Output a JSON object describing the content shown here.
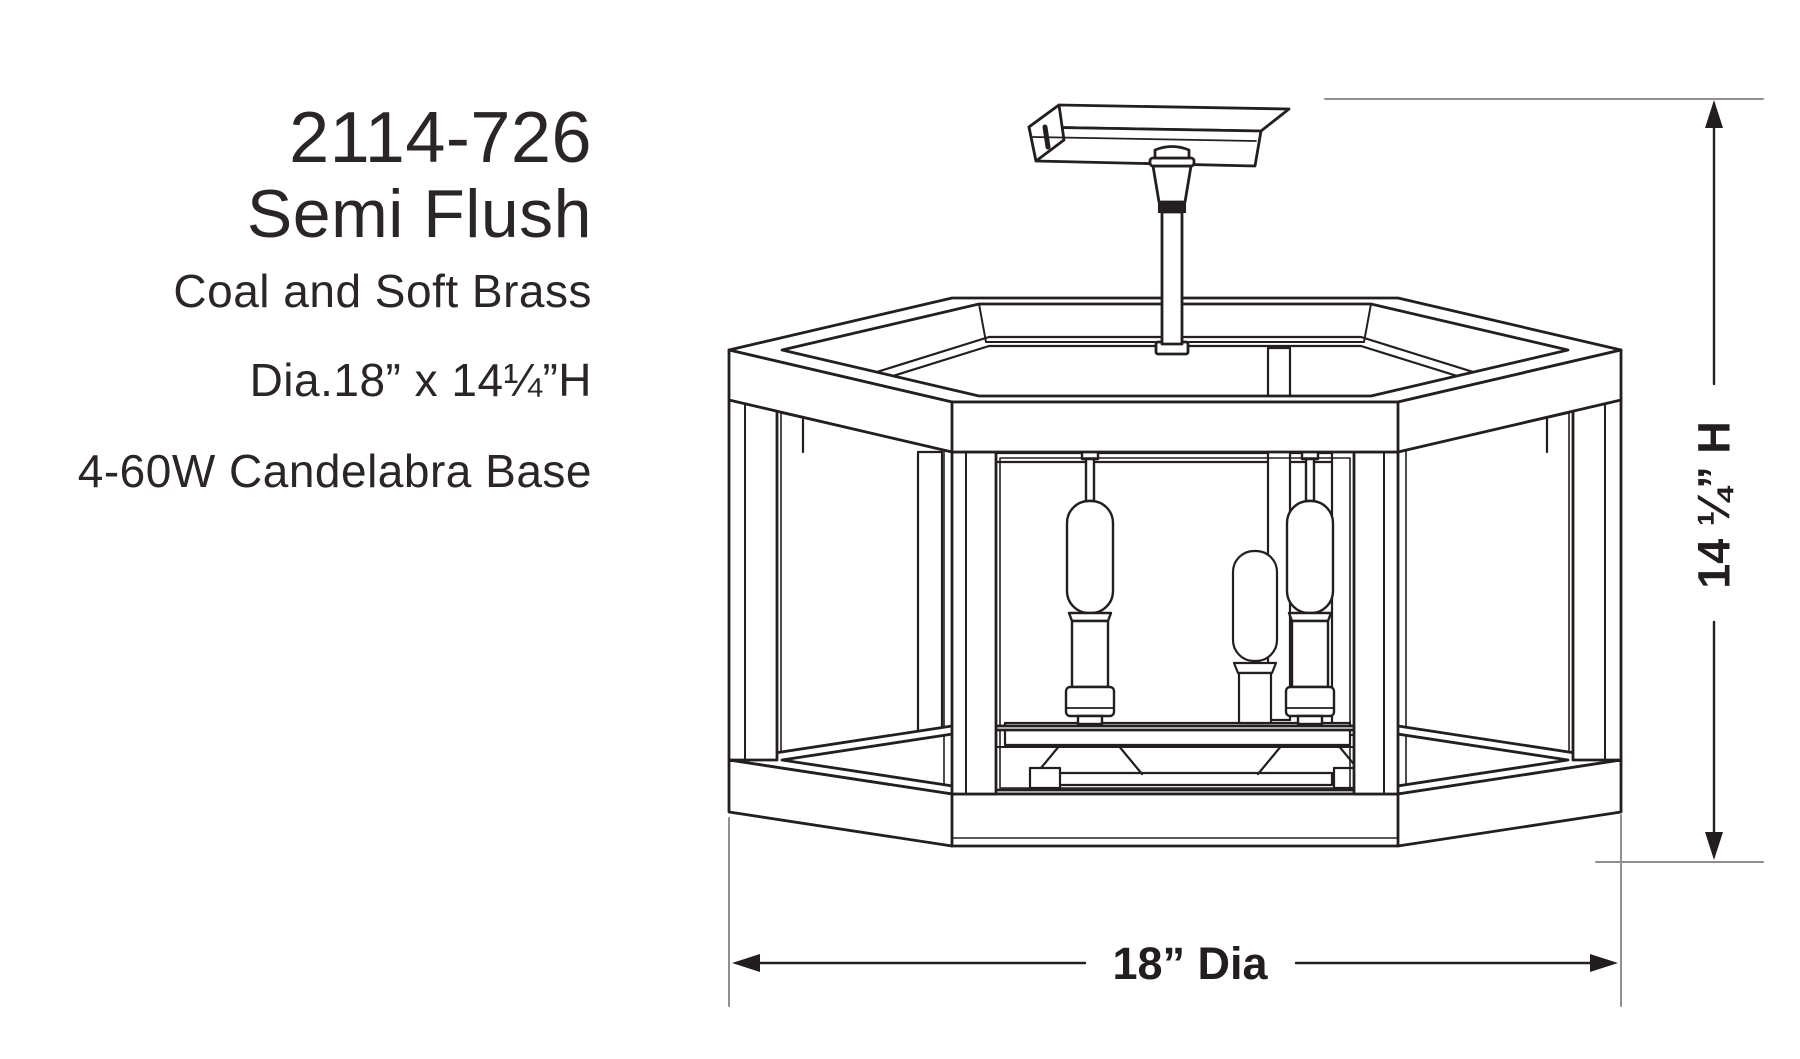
{
  "product": {
    "model": "2114-726",
    "mount_type": "Semi Flush",
    "finish": "Coal and Soft Brass",
    "size": "Dia.18” x 14¼”H",
    "lamping": "4-60W Candelabra Base"
  },
  "dimensions": {
    "height_label": "14 ¼” H",
    "diameter_label": "18” Dia"
  },
  "colors": {
    "line_art": "#231f20",
    "extension_line": "#8d8f92",
    "background": "#ffffff"
  }
}
